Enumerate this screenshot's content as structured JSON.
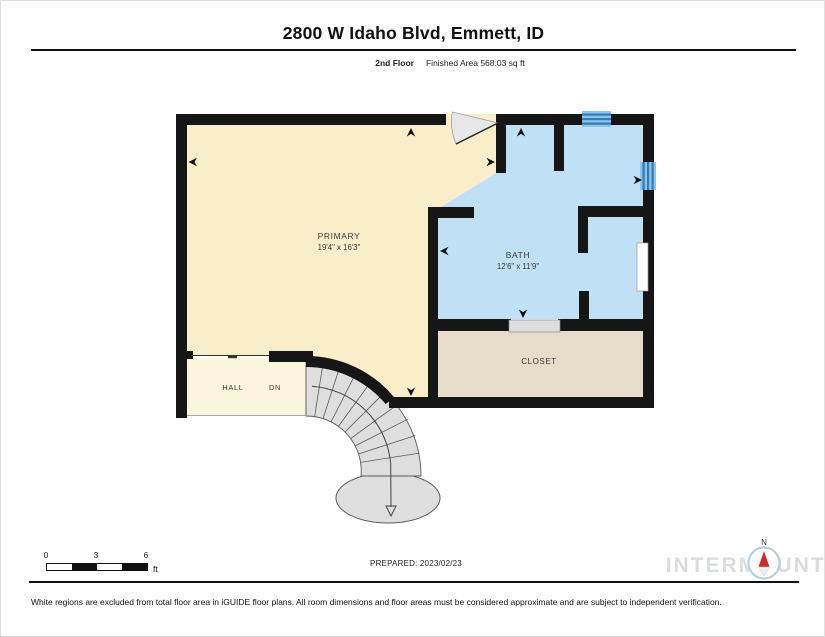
{
  "header": {
    "title": "2800 W Idaho Blvd, Emmett, ID",
    "floor_label": "2nd Floor",
    "area_label": "Finished Area 568.03 sq ft"
  },
  "rooms": {
    "primary": {
      "name": "PRIMARY",
      "dims": "19'4\" x 16'3\""
    },
    "bath": {
      "name": "BATH",
      "dims": "12'6\" x 11'9\""
    },
    "closet": {
      "name": "CLOSET"
    },
    "hall": {
      "name": "HALL"
    },
    "stairs": {
      "dn_label": "DN"
    }
  },
  "footer": {
    "scale": {
      "ticks": [
        "0",
        "3",
        "6"
      ],
      "unit": "ft"
    },
    "prepared": "PREPARED: 2023/02/23",
    "compass": {
      "north_label": "N"
    },
    "watermark": "INTERMOUNTAIN",
    "disclaimer": "White regions are excluded from total floor area in iGUIDE floor plans. All room dimensions and floor areas must be considered approximate and are subject to independent verification."
  },
  "colors": {
    "wall": "#161616",
    "primary_floor": "#FAEDC9",
    "hall_floor": "#FCF5DE",
    "bath_floor": "#BFE0F5",
    "closet_floor": "#E5DCCA",
    "stair_fill": "#DEDEDE",
    "stair_line": "#5a5a5a",
    "door_arc": "#E7E7E7",
    "window_light": "#8FC4E8",
    "window_dark": "#2F7CB6",
    "watermark": "#DADDE0",
    "compass_red": "#D22B2B"
  }
}
